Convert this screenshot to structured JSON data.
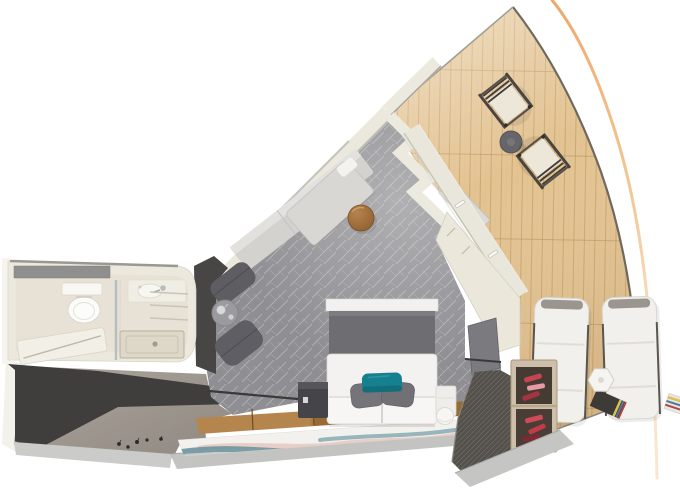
{
  "scene": {
    "kind": "3d-floor-plan-cutaway-render",
    "subject": "ship-stateroom-with-forward-balcony",
    "width": 680,
    "height": 491,
    "background": "#ffffff"
  },
  "colors": {
    "background": "#ffffff",
    "hull_accent": "#eda86a",
    "deck_wood": "#e3c392",
    "deck_plank_line": "#c59e63",
    "deck_edge": "#6e695f",
    "carpet": "#8f8f93",
    "carpet_pattern": "#d6d6da",
    "wall_cream": "#ebe8dd",
    "wall_white": "#f7f5f0",
    "wall_shadow": "#9d998f",
    "dark_wall": "#484645",
    "charcoal_floor": "#403e3c",
    "taupe_floor": "#a39c94",
    "cut_edge": "#c3c3c1",
    "sofa": "#d3d2cf",
    "daybed_panel": "#d8d7d4",
    "ottoman_brown": "#a97542",
    "armchair": "#5e5d62",
    "headboard": "#6e6d71",
    "bedding": "#f3f2f0",
    "pillow_gray": "#757479",
    "pillow_teal": "#17808f",
    "nightstand_dark": "#454449",
    "wood_floor_light": "#b5854e",
    "wood_floor_dark": "#9a6a34",
    "rug_base": "#f2f1ed",
    "rug_teal": "#6e939c",
    "rug_pink": "#e5c0ba",
    "rug_gray": "#c3c6c6",
    "chair_fabric": "#ece7d8",
    "chair_frame": "#4a453f",
    "bistro_table": "#65656a",
    "lounger": "#f1f0ec",
    "lounger_frame": "#57534d",
    "shelf_wood": "#cdbfa9",
    "cubby_dark": "#443b32",
    "shoe_red": "#c84454",
    "wardrobe_mesh": "#54504b",
    "bathroom_shell": "#ece8dd",
    "bathroom_floor": "#e7e2d5",
    "fixture_white": "#fcfcfa",
    "mirror_gray": "#8f8f8d",
    "glass_blue": "#a9b7bb"
  },
  "areas": {
    "bathroom": {
      "fixtures": [
        "mirror",
        "toilet",
        "washbasin",
        "faucet",
        "glass-partition",
        "shower-tray",
        "fold-bench",
        "towel-shelves"
      ]
    },
    "bedroom": {
      "furniture": [
        "wall-sofa-bench",
        "daybed-panel",
        "white-pillow",
        "round-ottoman",
        "armchair-cushions",
        "tea-table-with-kettle",
        "double-bed",
        "headboard",
        "nightstand-left",
        "nightstand-right",
        "round-stool",
        "tv-panel",
        "corner-cabinet",
        "accordion-door",
        "glass-partition-wall",
        "handrail"
      ],
      "bed_pillows": {
        "gray": 2,
        "teal": 1
      },
      "floor": [
        "patterned-carpet",
        "wood-floor-strip",
        "wave-pattern-runner-rug"
      ]
    },
    "balcony": {
      "deck": "wood-planks",
      "furniture": [
        "deck-chair",
        "deck-chair",
        "bistro-table",
        "sun-lounger",
        "sun-lounger",
        "hex-side-table",
        "towel-stack"
      ],
      "deck_chairs": 2,
      "sun_loungers": 2
    },
    "entry": {
      "floor": "taupe",
      "floor_marks": 5
    },
    "storage": {
      "units": [
        "shoe-shelf",
        "mesh-wardrobe"
      ],
      "shoe_pairs_visible": 6
    }
  }
}
